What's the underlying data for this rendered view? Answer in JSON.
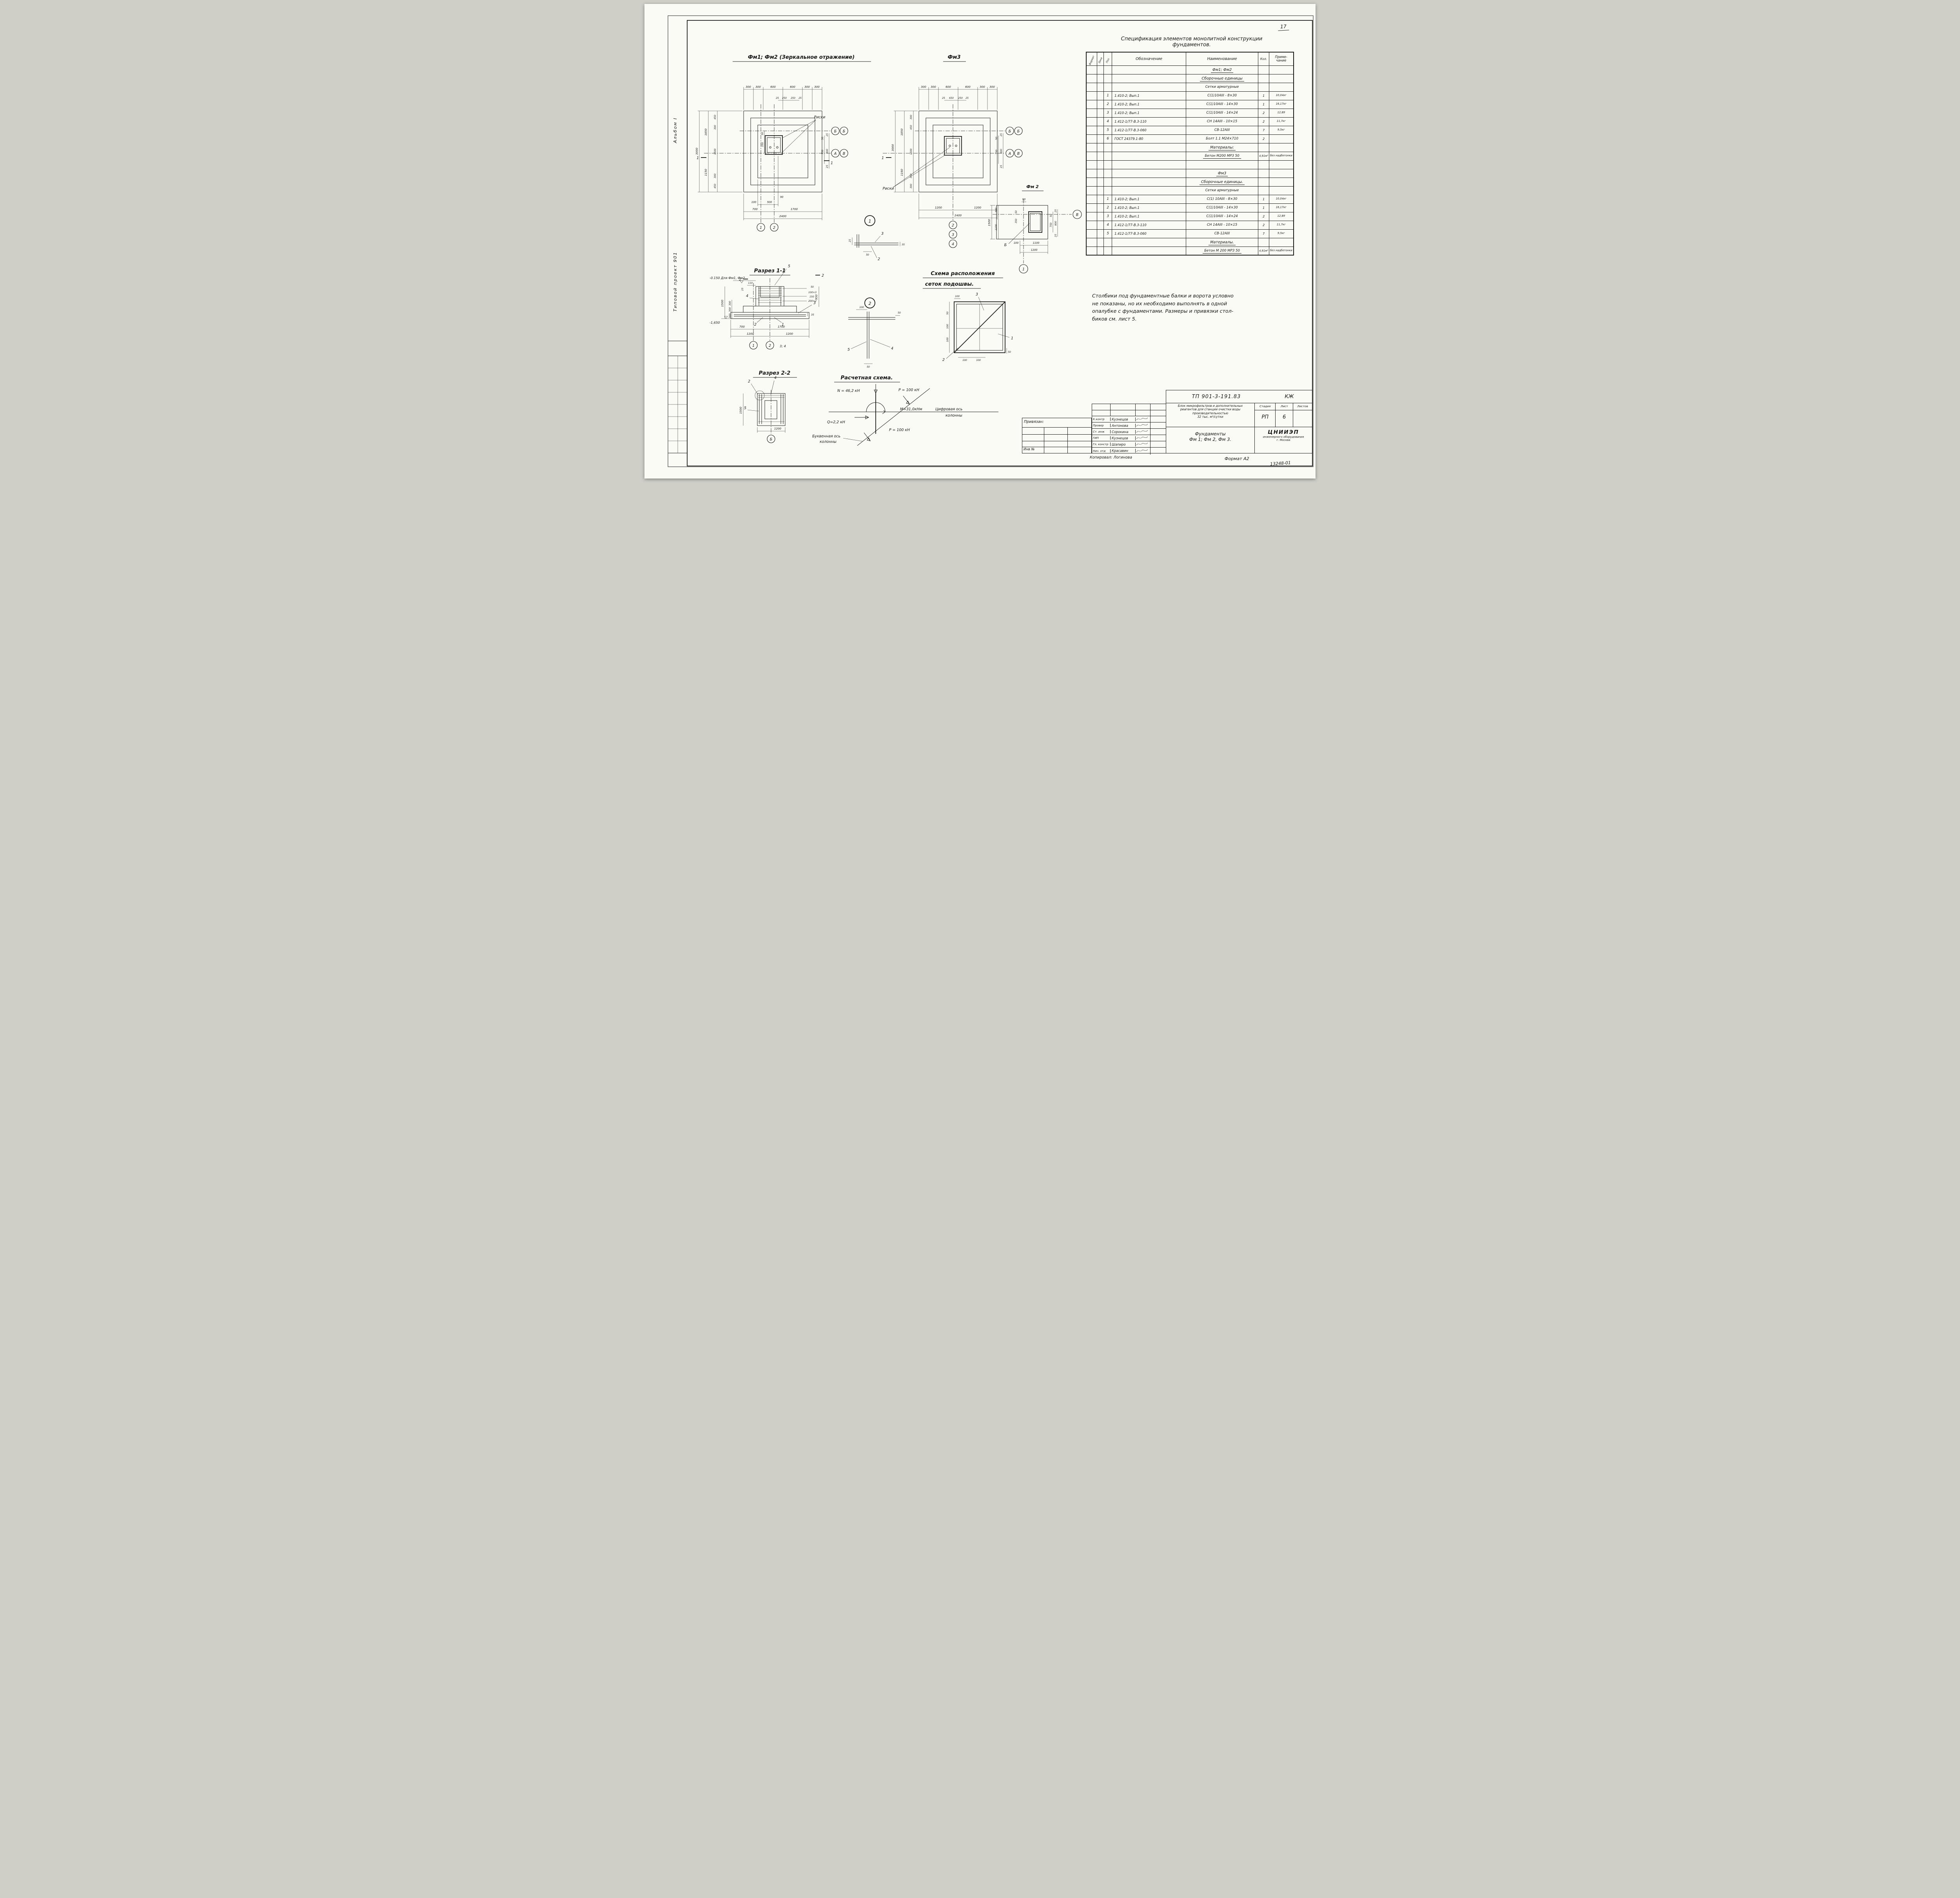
{
  "page": {
    "number": "17",
    "copied": "Копировал: Логинова",
    "format": "Формат А2",
    "stamp": "13248-01"
  },
  "margin": {
    "album": "Альбом I",
    "project": "Типовой проект 901"
  },
  "t": {
    "plan12": "Фм1; Фм2 (Зеркальное отражение)",
    "plan3": "Фм3",
    "plan2": "Фм 2",
    "s11": "Разрез 1-1",
    "s22": "Разрез 2-2",
    "calc": "Расчетная схема.",
    "mesh1": "Схема расположения",
    "mesh2": "сеток подошвы.",
    "riski": "Риски"
  },
  "spec": {
    "title1": "Спецификация элементов монолитной конструкции",
    "title2": "фундаментов.",
    "h": {
      "f": "Формат",
      "z": "Зона",
      "p": "Поз.",
      "d": "Обозначение",
      "n": "Наименование",
      "q": "Кол.",
      "pr1": "Приме-",
      "pr2": "чание"
    },
    "rows": [
      {
        "name": "Фм1; Фм2"
      },
      {
        "name": "Сборочные единицы"
      },
      {
        "name": "Сетки арматурные"
      },
      {
        "pos": "1",
        "des": "1.410-2; Вып.1",
        "name": "С(1)10АIII - 8×30",
        "qty": "1",
        "note": "10,04кг"
      },
      {
        "pos": "2",
        "des": "1.410-2; Вып.1",
        "name": "С(1)10АIII - 14×30",
        "qty": "1",
        "note": "16,17кг"
      },
      {
        "pos": "3",
        "des": "1.410-2; Вып.1",
        "name": "С(1)10АIII - 14×24",
        "qty": "2",
        "note": "12,89"
      },
      {
        "pos": "4",
        "des": "1.412-1/77-В.3-110",
        "name": "СН 14АIII - 10×15",
        "qty": "2",
        "note": "11,7кг"
      },
      {
        "pos": "5",
        "des": "1.412-1/77-В.3-060",
        "name": "СВ-12АIII",
        "qty": "7",
        "note": "9,5кг"
      },
      {
        "pos": "6",
        "des": "ГОСТ 24379.1-80",
        "name": "Болт 1.1 М24×710",
        "qty": "2",
        "note": ""
      },
      {
        "name": "Материалы:"
      },
      {
        "name": "Бетон М200 МРЗ 50",
        "qty": "4,91м³",
        "note": "без надбетонки"
      },
      {
        "name": ""
      },
      {
        "name": "Фм3"
      },
      {
        "name": "Сборочные единицы."
      },
      {
        "name": "Сетки арматурные"
      },
      {
        "pos": "1",
        "des": "1.410-2; Вып.1",
        "name": "С(1) 10АIII - 8×30",
        "qty": "1",
        "note": "10,04кг"
      },
      {
        "pos": "2",
        "des": "1.410-2; Вып.1",
        "name": "С(1)10АIII - 14×30",
        "qty": "1",
        "note": "16,17кг"
      },
      {
        "pos": "3",
        "des": "1.410-2; Вып.1",
        "name": "С(1)10АIII - 14×24",
        "qty": "2",
        "note": "12,89"
      },
      {
        "pos": "4",
        "des": "1.412-1/77-В.3-110",
        "name": "СН 14АIII - 10×15",
        "qty": "2",
        "note": "11,7кг"
      },
      {
        "pos": "5",
        "des": "1.412-1/77-В.3-060",
        "name": "СВ-12АIII",
        "qty": "7",
        "note": "9,5кг"
      },
      {
        "name": "Материалы."
      },
      {
        "name": "Бетон М 200 МРЗ 50",
        "qty": "4,91м³",
        "note": "без надбетонки"
      }
    ]
  },
  "note": {
    "l1": "Столбики под фундаментные балки и ворота условно",
    "l2": "не показаны, но их необходимо выполнять в одной",
    "l3": "опалубке с фундаментами. Размеры и привязки стол-",
    "l4": "биков см. лист 5."
  },
  "p12": {
    "top": [
      "300",
      "300",
      "600",
      "600",
      "300",
      "300"
    ],
    "top2": [
      "25",
      "250",
      "250",
      "25"
    ],
    "d3000": "3000",
    "d1850": "1850",
    "d1150": "1150",
    "col": [
      "450",
      "300",
      "1500",
      "300",
      "450"
    ],
    "off": [
      "50",
      "350"
    ],
    "right": [
      "25",
      "50",
      "750",
      "800",
      "25"
    ],
    "d90": "90",
    "d100": "100",
    "d500": "500",
    "d700": "700",
    "d1700": "1700",
    "d2400": "2400",
    "axh": [
      "Б",
      "Б",
      "А",
      "В"
    ],
    "axv": [
      "1",
      "2"
    ],
    "cut": "1"
  },
  "p3": {
    "top": [
      "300",
      "300",
      "600",
      "600",
      "300",
      "300"
    ],
    "top2": [
      "25",
      "650",
      "250",
      "25"
    ],
    "d3000": "3000",
    "d1850": "1850",
    "d1160": "1160",
    "col": [
      "300",
      "450",
      "1500",
      "350",
      "300"
    ],
    "right": [
      "25",
      "50",
      "750",
      "800",
      "25"
    ],
    "b1200": [
      "1200",
      "1200"
    ],
    "d2400": "2400",
    "axh": [
      "Б",
      "Б",
      "А",
      "В"
    ],
    "axv": [
      "2",
      "3",
      "4"
    ],
    "cut": "1"
  },
  "p2": {
    "d90": "90",
    "d1500": "1500",
    "d400": "400",
    "d1100": "1100",
    "off": [
      "50",
      "350"
    ],
    "right": [
      "25",
      "50",
      "750",
      "800",
      "25"
    ],
    "b100": "100",
    "b1100": "1100",
    "b1200": "1200",
    "axv": "В",
    "ax1": "1",
    "axb": "Б"
  },
  "s11": {
    "elevTop": "-0.150 Для Фм1, Фм2",
    "elevBot": "-1,650",
    "d1500": "1500",
    "c300": [
      "300",
      "300",
      "300"
    ],
    "d110": "110",
    "d25": "25",
    "r": [
      "50",
      "100×3",
      "150",
      "200×2"
    ],
    "d950": "950",
    "d35": "35",
    "b700": "700",
    "b1700": "1700",
    "b1200": [
      "1200",
      "1200"
    ],
    "ax": [
      "1",
      "2"
    ],
    "axNote": "3; 4",
    "cut": "2",
    "k": [
      "5",
      "4",
      "3",
      "2",
      "1"
    ]
  },
  "s22": {
    "d1500": "1500",
    "b1200": "1200",
    "k2": "2",
    "k4": "4",
    "k5": "5",
    "ax": "Б"
  },
  "d1": {
    "no": "1",
    "k3": "3",
    "k2": "2",
    "d25": "25",
    "d50": "50",
    "d35": "35"
  },
  "d2": {
    "no": "2",
    "k5": "5",
    "k4": "4",
    "d100": "100",
    "d50a": "50",
    "d50b": "50"
  },
  "mesh": {
    "k3": "3",
    "k1": "1",
    "k2": "2",
    "dims": [
      "100",
      "50",
      "100",
      "100",
      "100",
      "100",
      "50"
    ]
  },
  "calc": {
    "n": "N = 46,2 кН",
    "p1": "P = 100 кН",
    "m": "М=31,0кНм",
    "ax1a": "Цифровая ось",
    "ax1b": "колонны",
    "q": "Q=2,2 кН",
    "p2": "P = 100 кН",
    "ax2a": "Буквенная ось",
    "ax2b": "колонны"
  },
  "tb": {
    "doc": "ТП 901-3-191.83",
    "mark": "КЖ",
    "desc1": "Блок микрофильтров и дополнительных",
    "desc2": "реагентов для станции очистки воды",
    "desc3": "производительностью",
    "desc4": "32 тыс. м³/сутки",
    "stageH": "Стадия",
    "sheetH": "Лист",
    "sheetsH": "Листов",
    "stage": "РП",
    "sheet": "6",
    "sheets": "",
    "obj1": "Фундаменты",
    "obj2": "Фм 1; Фм 2, Фм 3.",
    "org1": "ЦНИИЭП",
    "org2": "инженерного оборудования",
    "org3": "г. Москва",
    "attached": "Привязан:",
    "inv": "Инв №",
    "people": [
      {
        "r": "К.контр",
        "n": "Кузнецов"
      },
      {
        "r": "Провер",
        "n": "Антонова"
      },
      {
        "r": "Ст. инж",
        "n": "Сорокина"
      },
      {
        "r": "ГИП",
        "n": "Кузнецов"
      },
      {
        "r": "Гл. констр",
        "n": "Шапиро"
      },
      {
        "r": "Нач. отд",
        "n": "Красавин"
      }
    ]
  }
}
